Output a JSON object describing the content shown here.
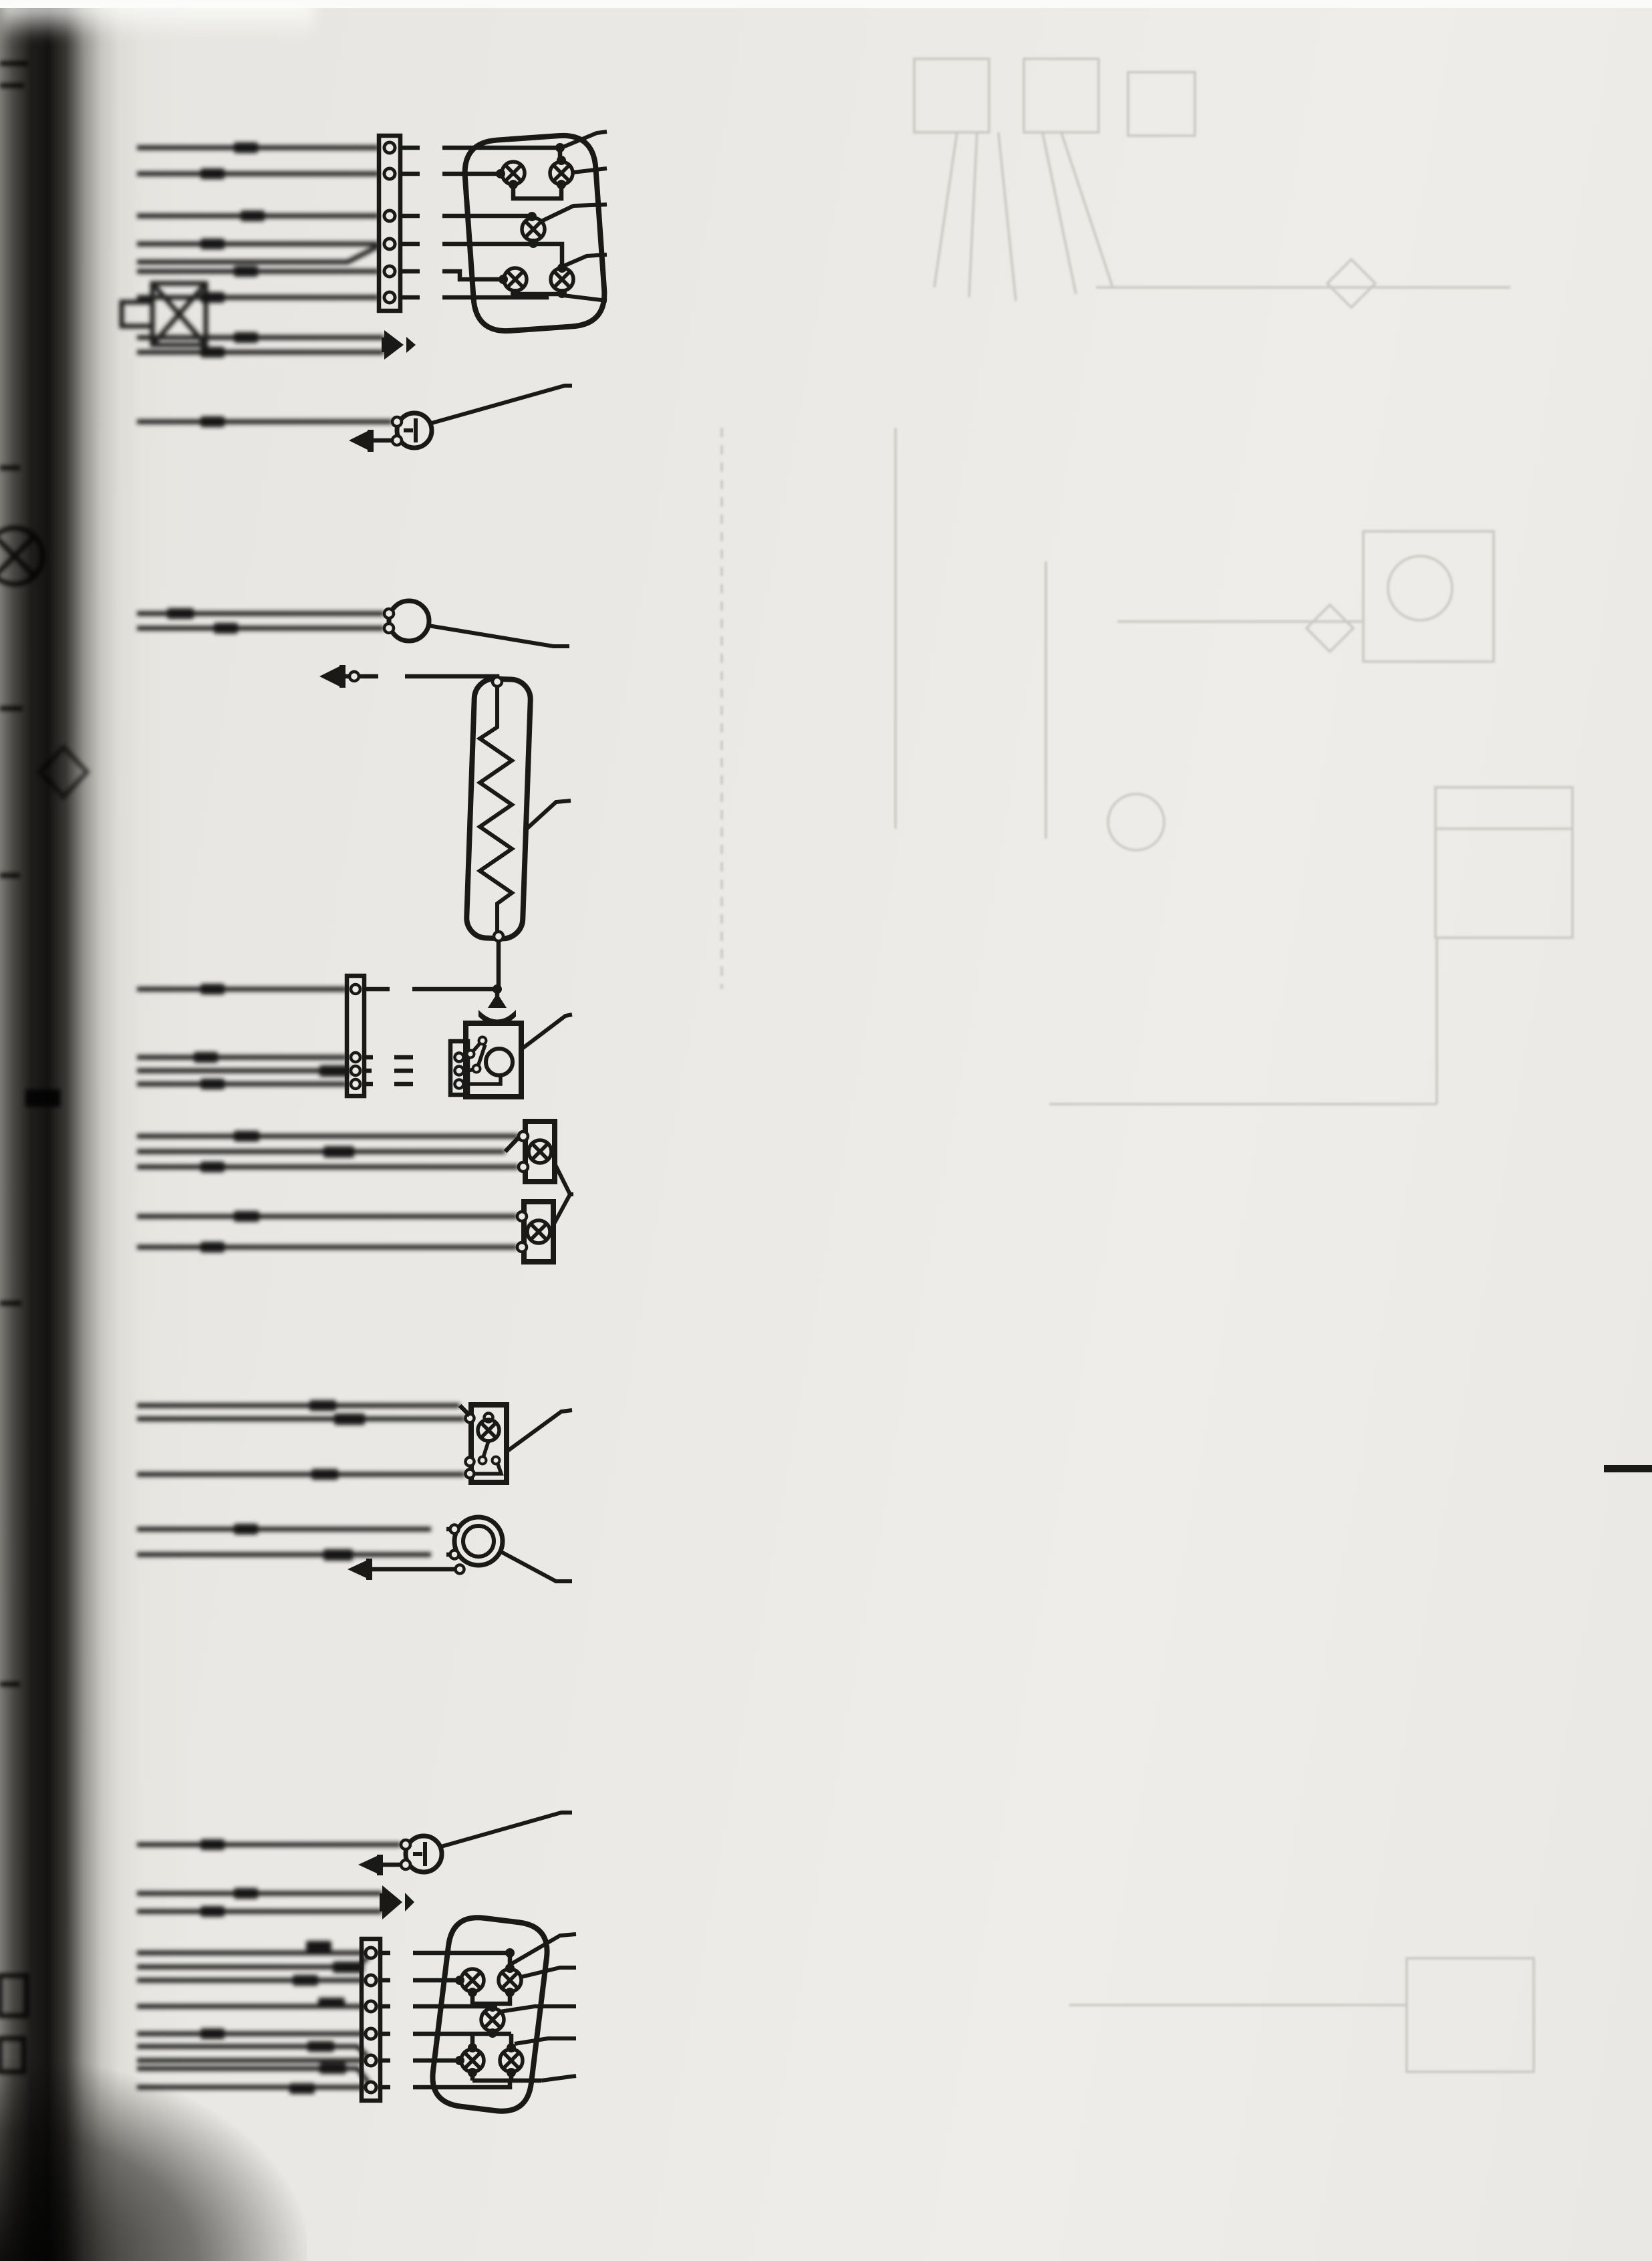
{
  "page": {
    "number": "353",
    "chapter_tab": "13"
  },
  "wiring": {
    "rear_lamp_cluster_top": {
      "wire_labels": [
        "R",
        "A",
        "G",
        "N",
        "B",
        "V"
      ],
      "callouts": [
        "80",
        "81",
        "82",
        "83",
        "84"
      ]
    },
    "license_plate_lamp_top": {
      "callout": "68"
    },
    "switch_90": {
      "callout": "90"
    },
    "heated_rear_window_89": {
      "callout": "89",
      "wire_label": "N"
    },
    "wiper_motor_88": {
      "callout": "88",
      "wire_labels": [
        "N",
        "C",
        "H",
        "V"
      ],
      "terminals": [
        "53a",
        "31b",
        "53"
      ]
    },
    "marker_lamps_87": {
      "callout": "87"
    },
    "lamp_with_switch_86": {
      "callout": "86"
    },
    "fuel_sender_85": {
      "callout": "85",
      "wire_labels": [
        "T",
        "W"
      ]
    },
    "license_plate_lamp_bottom": {
      "callout": "68"
    },
    "rear_lamp_cluster_bottom": {
      "wire_labels": [
        "R",
        "A",
        "C",
        "N",
        "B",
        "V"
      ],
      "callouts": [
        "84",
        "83",
        "82",
        "81",
        "80"
      ]
    }
  },
  "ghost": {
    "title_line1": "SAMOCHÓD FSO POLONEZ",
    "title_line2": "CARO 1.4 GL",
    "chapter_number": "14",
    "section_heading": "OPIS OGÓLNY SAMOCHODU",
    "section_number": "14.1",
    "heading2_line1": "DANE IDENTYFIKACYJNE",
    "heading2_line2": "I TECHNICZNE SAMOCHODU",
    "page_number": "354",
    "diagram_callouts": [
      "175",
      "35",
      "176",
      "177",
      "178",
      "22",
      "179",
      "180",
      "10",
      "181",
      "54",
      "49"
    ]
  }
}
